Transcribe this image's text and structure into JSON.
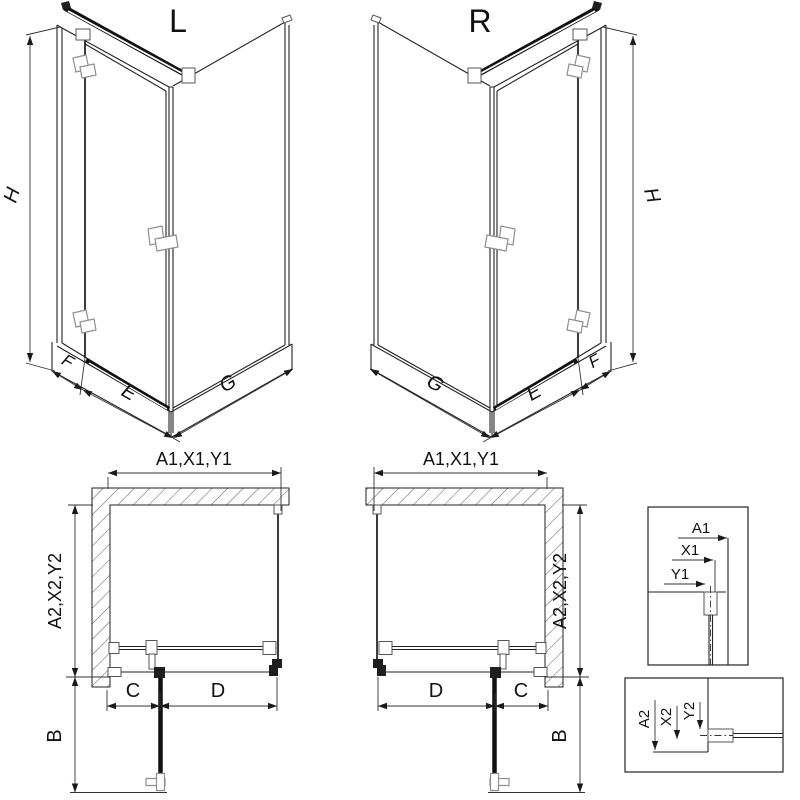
{
  "iso": {
    "left": {
      "label": "L",
      "h": "H",
      "f": "F",
      "e": "E",
      "g": "G"
    },
    "right": {
      "label": "R",
      "h": "H",
      "f": "F",
      "e": "E",
      "g": "G"
    }
  },
  "plan": {
    "left": {
      "top": "A1,X1,Y1",
      "side": "A2,X2,Y2",
      "c": "C",
      "d": "D",
      "b": "B"
    },
    "right": {
      "top": "A1,X1,Y1",
      "side": "A2,X2,Y2",
      "c": "C",
      "d": "D",
      "b": "B"
    }
  },
  "details": {
    "top": {
      "a1": "A1",
      "x1": "X1",
      "y1": "Y1"
    },
    "bottom": {
      "a2": "A2",
      "x2": "X2",
      "y2": "Y2"
    }
  },
  "colors": {
    "line": "#1a1a1a",
    "hardware_gray": "#8f8f8f",
    "background": "#ffffff"
  }
}
